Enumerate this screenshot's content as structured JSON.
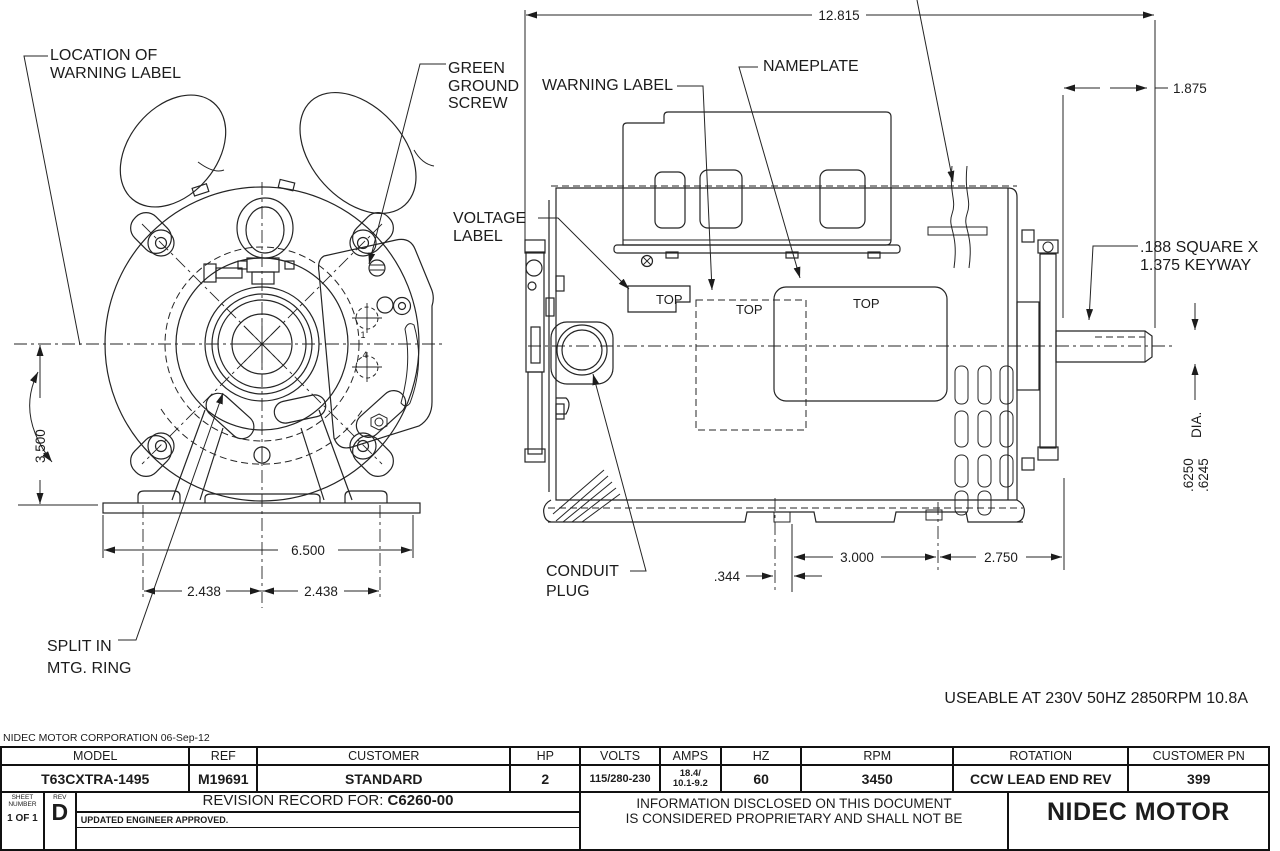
{
  "front_view": {
    "labels": {
      "warning_location": [
        "LOCATION OF",
        "WARNING LABEL"
      ],
      "ground_screw": [
        "GREEN",
        "GROUND",
        "SCREW"
      ],
      "split_ring": [
        "SPLIT IN",
        "MTG. RING"
      ]
    },
    "terminal_marks": [
      "1",
      "4"
    ],
    "dims": {
      "height": "3.500",
      "base_width": "6.500",
      "foot_left": "2.438",
      "foot_right": "2.438"
    }
  },
  "side_view": {
    "labels": {
      "warning": "WARNING LABEL",
      "nameplate": "NAMEPLATE",
      "voltage": [
        "VOLTAGE",
        "LABEL"
      ],
      "conduit": [
        "CONDUIT",
        "PLUG"
      ],
      "top_voltage": "TOP",
      "top_warning": "TOP",
      "top_nameplate": "TOP"
    },
    "dims": {
      "overall_length": "12.815",
      "shaft_length": "1.875",
      "keyway": [
        ".188 SQUARE X",
        "1.375 KEYWAY"
      ],
      "shaft_dia": [
        ".6250",
        ".6245"
      ],
      "dia_label": "DIA.",
      "conduit_offset": ".344",
      "foot_spacing": "3.000",
      "foot_to_shoulder": "2.750"
    }
  },
  "note": "USEABLE AT 230V 50HZ 2850RPM 10.8A",
  "title_block": {
    "corporation": "NIDEC MOTOR CORPORATION 06-Sep-12",
    "columns": [
      {
        "header": "MODEL",
        "value": "T63CXTRA-1495"
      },
      {
        "header": "REF",
        "value": "M19691"
      },
      {
        "header": "CUSTOMER",
        "value": "STANDARD"
      },
      {
        "header": "HP",
        "value": "2"
      },
      {
        "header": "VOLTS",
        "value": "115/280-230"
      },
      {
        "header": "AMPS",
        "value": "18.4/",
        "value2": "10.1-9.2"
      },
      {
        "header": "HZ",
        "value": "60"
      },
      {
        "header": "RPM",
        "value": "3450"
      },
      {
        "header": "ROTATION",
        "value": "CCW LEAD END REV"
      },
      {
        "header": "CUSTOMER PN",
        "value": "399"
      }
    ],
    "sheet": {
      "label_line1": "SHEET",
      "label_line2": "NUMBER",
      "value": "1 OF 1"
    },
    "rev": {
      "label": "REV",
      "value": "D"
    },
    "revision_record": {
      "prefix": "REVISION RECORD FOR: ",
      "number": "C6260-00",
      "note": "UPDATED ENGINEER APPROVED."
    },
    "proprietary": [
      "INFORMATION DISCLOSED ON THIS DOCUMENT",
      "IS CONSIDERED PROPRIETARY AND SHALL NOT BE"
    ],
    "brand": "NIDEC MOTOR"
  },
  "colors": {
    "ink": "#1c1c1c",
    "background": "#ffffff"
  }
}
